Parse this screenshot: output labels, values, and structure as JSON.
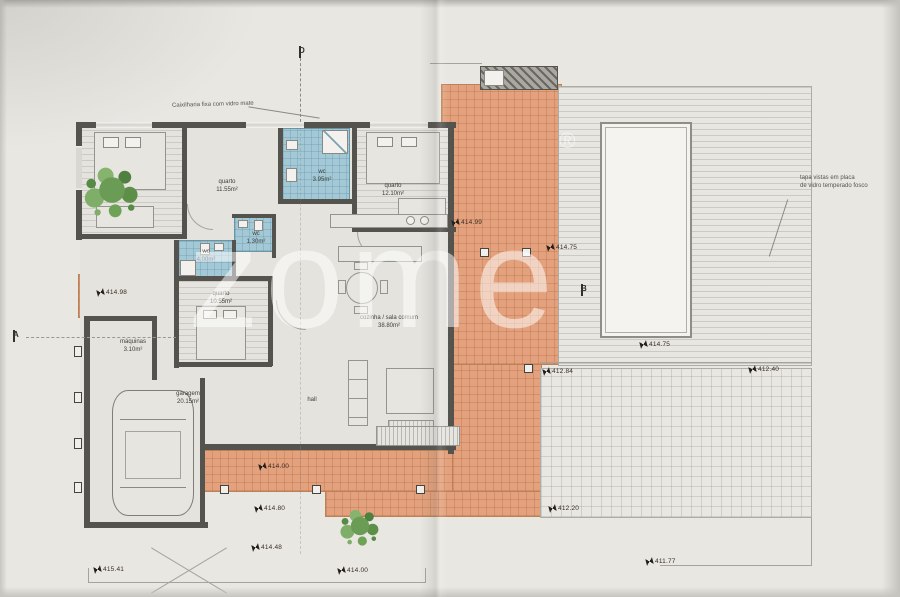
{
  "watermark": {
    "text": "zome",
    "reg": "®"
  },
  "annotations": {
    "caixilharia": "Caixilharia fixa com vidro mate",
    "tapa_vistas_line1": "tapa vistas em placa",
    "tapa_vistas_line2": "de vidro temperado fosco"
  },
  "rooms": [
    {
      "name": "quarto",
      "area": "11.55m²",
      "x": 227,
      "y": 186
    },
    {
      "name": "wc",
      "area": "3.95m²",
      "x": 322,
      "y": 176
    },
    {
      "name": "quarto",
      "area": "12.10m²",
      "x": 393,
      "y": 190
    },
    {
      "name": "wc",
      "area": "1.30m²",
      "x": 256,
      "y": 238
    },
    {
      "name": "wc",
      "area": "4.00m²",
      "x": 206,
      "y": 256
    },
    {
      "name": "quarto",
      "area": "10.55m²",
      "x": 221,
      "y": 298
    },
    {
      "name": "máquinas",
      "area": "3.10m²",
      "x": 133,
      "y": 346
    },
    {
      "name": "garagem",
      "area": "20.15m²",
      "x": 188,
      "y": 398
    },
    {
      "name": "hall",
      "area": "",
      "x": 312,
      "y": 400
    },
    {
      "name": "cozinha / sala comum",
      "area": "38.80m²",
      "x": 389,
      "y": 322
    }
  ],
  "elevation_markers": [
    {
      "value": "414.98",
      "x": 97,
      "y": 289
    },
    {
      "value": "414.99",
      "x": 452,
      "y": 219
    },
    {
      "value": "414.75",
      "x": 547,
      "y": 244
    },
    {
      "value": "414.75",
      "x": 640,
      "y": 341
    },
    {
      "value": "412.84",
      "x": 543,
      "y": 368
    },
    {
      "value": "412.40",
      "x": 749,
      "y": 366
    },
    {
      "value": "414.00",
      "x": 259,
      "y": 463
    },
    {
      "value": "414.80",
      "x": 255,
      "y": 505
    },
    {
      "value": "414.48",
      "x": 252,
      "y": 544
    },
    {
      "value": "415.41",
      "x": 94,
      "y": 566
    },
    {
      "value": "414.00",
      "x": 338,
      "y": 567
    },
    {
      "value": "412.20",
      "x": 549,
      "y": 505
    },
    {
      "value": "411.77",
      "x": 646,
      "y": 558
    }
  ],
  "section_markers": [
    {
      "label": "D",
      "x": 299,
      "y": 46
    },
    {
      "label": "A",
      "x": 13,
      "y": 330
    },
    {
      "label": "B",
      "x": 581,
      "y": 284
    }
  ],
  "colors": {
    "terrace": "#e3a27d",
    "wall": "#55534e",
    "wc_blue": "#a3c8d6",
    "paper": "#e9e7e2",
    "tree_green": "#6a9c55",
    "watermark": "rgba(255,255,255,0.52)",
    "marker_text": "#3a2c22"
  }
}
